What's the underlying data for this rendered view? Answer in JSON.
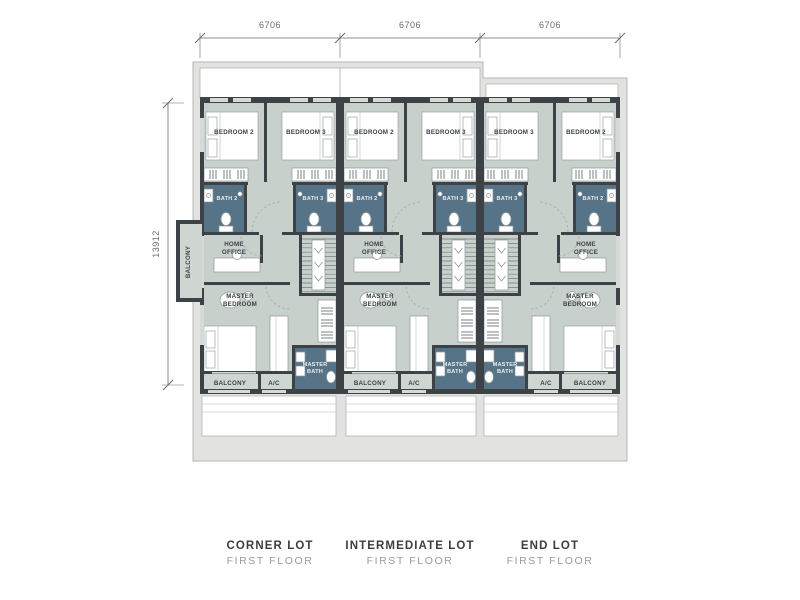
{
  "dimensions": {
    "top": [
      "6706",
      "6706",
      "6706"
    ],
    "side": "13912"
  },
  "units": [
    {
      "title": "CORNER LOT",
      "subtitle": "FIRST FLOOR",
      "rooms": {
        "bedroom2": "BEDROOM 2",
        "bedroom3": "BEDROOM 3",
        "bath2": "BATH 2",
        "bath3": "BATH 3",
        "home_office": [
          "HOME",
          "OFFICE"
        ],
        "master_bedroom": [
          "MASTER",
          "BEDROOM"
        ],
        "master_bath": [
          "MASTER",
          "BATH"
        ],
        "balcony": "BALCONY",
        "ac": "A/C",
        "side_balcony": "BALCONY"
      }
    },
    {
      "title": "INTERMEDIATE LOT",
      "subtitle": "FIRST FLOOR",
      "rooms": {
        "bedroom2": "BEDROOM 2",
        "bedroom3": "BEDROOM 3",
        "bath2": "BATH 2",
        "bath3": "BATH 3",
        "home_office": [
          "HOME",
          "OFFICE"
        ],
        "master_bedroom": [
          "MASTER",
          "BEDROOM"
        ],
        "master_bath": [
          "MASTER",
          "BATH"
        ],
        "balcony": "BALCONY",
        "ac": "A/C"
      }
    },
    {
      "title": "END LOT",
      "subtitle": "FIRST FLOOR",
      "rooms": {
        "bedroom2": "BEDROOM 2",
        "bedroom3": "BEDROOM 3",
        "bath2": "BATH 2",
        "bath3": "BATH 3",
        "home_office": [
          "HOME",
          "OFFICE"
        ],
        "master_bedroom": [
          "MASTER",
          "BEDROOM"
        ],
        "master_bath": [
          "MASTER",
          "BATH"
        ],
        "balcony": "BALCONY",
        "ac": "A/C"
      }
    }
  ],
  "colors": {
    "floor": "#c8d0cc",
    "balcony_floor": "#cfd6d2",
    "bath": "#567387",
    "wall": "#3c4245",
    "band": "#e2e2e0",
    "band_stroke": "#b5b5b3",
    "white": "#ffffff",
    "window": "#d6dad7",
    "fixture_stroke": "#8e9699",
    "stair_line": "#747c7f",
    "door_arc": "#a5aba9",
    "room_text": "#3c4245",
    "bath_text": "#e8eef0",
    "dim": "#6a6a6a",
    "caption_title": "#3d3d3d",
    "caption_sub": "#9b9b9b"
  }
}
